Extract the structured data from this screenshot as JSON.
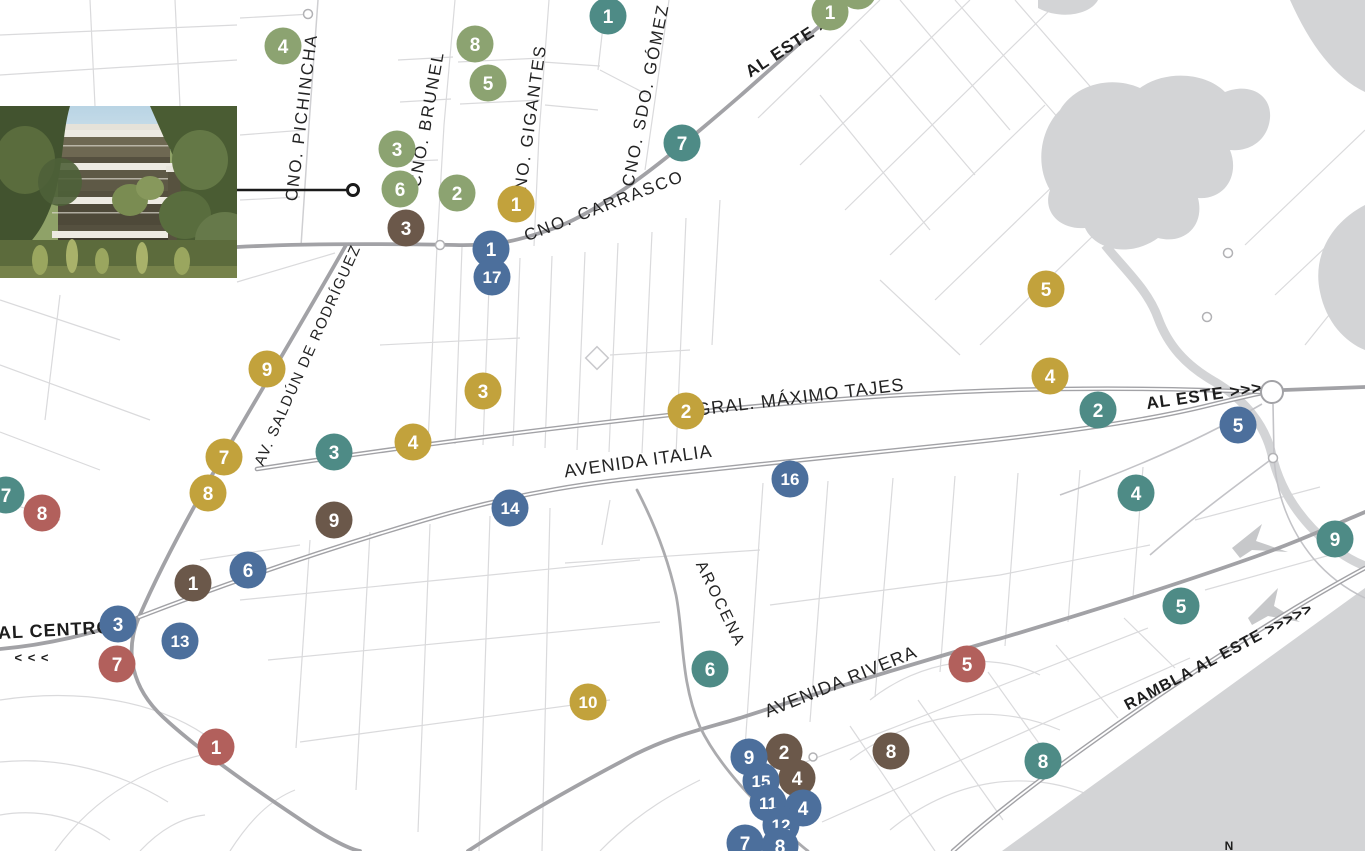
{
  "map": {
    "colors": {
      "background": "#ffffff",
      "water": "#d3d4d6",
      "road_main": "#a2a2a6",
      "road_secondary": "#c3c3c7",
      "road_minor": "#dadadc",
      "label_text": "#232323",
      "connector": "#1a1a1a"
    },
    "marker_colors": {
      "green": "#8ca371",
      "teal": "#4e8b86",
      "gold": "#c2a23c",
      "brown": "#6b584a",
      "blue": "#4c6f9c",
      "red": "#b2605c"
    },
    "street_labels": [
      {
        "text": "CNO. PICHINCHA",
        "x": 307,
        "y": 118,
        "rot": -83,
        "size": 17,
        "ls": 2
      },
      {
        "text": "CNO. BRUNEL",
        "x": 432,
        "y": 120,
        "rot": -80,
        "size": 17,
        "ls": 2
      },
      {
        "text": "CNO. GIGANTES",
        "x": 535,
        "y": 125,
        "rot": -82,
        "size": 17,
        "ls": 2
      },
      {
        "text": "CNO. SDO. GÓMEZ",
        "x": 651,
        "y": 96,
        "rot": -79,
        "size": 17,
        "ls": 2
      },
      {
        "text": "CNO. CARRASCO",
        "x": 606,
        "y": 211,
        "rot": -21,
        "size": 17,
        "ls": 2
      },
      {
        "text": "AV. SALDÚN DE RODRÍGUEZ",
        "x": 312,
        "y": 357,
        "rot": -66,
        "size": 15,
        "ls": 1.5
      },
      {
        "text": "GRAL. MÁXIMO TAJES",
        "x": 801,
        "y": 403,
        "rot": -7,
        "size": 18,
        "ls": 1
      },
      {
        "text": "AVENIDA ITALIA",
        "x": 639,
        "y": 467,
        "rot": -8,
        "size": 18,
        "ls": 1
      },
      {
        "text": "AROCENA",
        "x": 716,
        "y": 606,
        "rot": 64,
        "size": 16,
        "ls": 2
      },
      {
        "text": "AVENIDA RIVERA",
        "x": 843,
        "y": 687,
        "rot": -22,
        "size": 18,
        "ls": 1
      }
    ],
    "direction_labels": [
      {
        "text": "AL ESTE >",
        "x": 790,
        "y": 52,
        "rot": -33,
        "size": 17,
        "ls": 1
      },
      {
        "text": "AL ESTE >>>",
        "x": 1205,
        "y": 401,
        "rot": -8,
        "size": 17,
        "ls": 1
      },
      {
        "text": "AL CENTRO",
        "x": 55,
        "y": 636,
        "rot": -3,
        "size": 18,
        "ls": 1
      },
      {
        "text": "< < <",
        "x": 32,
        "y": 662,
        "rot": 0,
        "size": 13,
        "ls": 1
      },
      {
        "text": "RAMBLA AL ESTE >>>>>",
        "x": 1221,
        "y": 661,
        "rot": -28,
        "size": 16,
        "ls": 1
      },
      {
        "text": "N",
        "x": 1229,
        "y": 850,
        "rot": 0,
        "size": 12,
        "ls": 0
      }
    ],
    "markers": [
      {
        "num": "4",
        "color": "green",
        "x": 283,
        "y": 46
      },
      {
        "num": "8",
        "color": "green",
        "x": 475,
        "y": 44
      },
      {
        "num": "5",
        "color": "green",
        "x": 488,
        "y": 83
      },
      {
        "num": "1",
        "color": "teal",
        "x": 608,
        "y": 16
      },
      {
        "num": "1",
        "color": "green",
        "x": 830,
        "y": 12
      },
      {
        "num": "",
        "color": "green",
        "x": 858,
        "y": -9
      },
      {
        "num": "7",
        "color": "teal",
        "x": 682,
        "y": 143
      },
      {
        "num": "3",
        "color": "green",
        "x": 397,
        "y": 149
      },
      {
        "num": "6",
        "color": "green",
        "x": 400,
        "y": 189
      },
      {
        "num": "2",
        "color": "green",
        "x": 457,
        "y": 193
      },
      {
        "num": "1",
        "color": "gold",
        "x": 516,
        "y": 204
      },
      {
        "num": "3",
        "color": "brown",
        "x": 406,
        "y": 228
      },
      {
        "num": "1",
        "color": "blue",
        "x": 491,
        "y": 249
      },
      {
        "num": "17",
        "color": "blue",
        "x": 492,
        "y": 277
      },
      {
        "num": "9",
        "color": "gold",
        "x": 267,
        "y": 369
      },
      {
        "num": "3",
        "color": "gold",
        "x": 483,
        "y": 391
      },
      {
        "num": "2",
        "color": "gold",
        "x": 686,
        "y": 411
      },
      {
        "num": "5",
        "color": "gold",
        "x": 1046,
        "y": 289
      },
      {
        "num": "4",
        "color": "gold",
        "x": 1050,
        "y": 376
      },
      {
        "num": "2",
        "color": "teal",
        "x": 1098,
        "y": 410
      },
      {
        "num": "5",
        "color": "blue",
        "x": 1238,
        "y": 425
      },
      {
        "num": "7",
        "color": "gold",
        "x": 224,
        "y": 457
      },
      {
        "num": "8",
        "color": "gold",
        "x": 208,
        "y": 493
      },
      {
        "num": "3",
        "color": "teal",
        "x": 334,
        "y": 452
      },
      {
        "num": "4",
        "color": "gold",
        "x": 413,
        "y": 442
      },
      {
        "num": "4",
        "color": "teal",
        "x": 1136,
        "y": 493
      },
      {
        "num": "9",
        "color": "teal",
        "x": 1335,
        "y": 539
      },
      {
        "num": "16",
        "color": "blue",
        "x": 790,
        "y": 479
      },
      {
        "num": "14",
        "color": "blue",
        "x": 510,
        "y": 508
      },
      {
        "num": "9",
        "color": "brown",
        "x": 334,
        "y": 520
      },
      {
        "num": "7",
        "color": "teal",
        "x": 6,
        "y": 495
      },
      {
        "num": "8",
        "color": "red",
        "x": 42,
        "y": 513
      },
      {
        "num": "1",
        "color": "brown",
        "x": 193,
        "y": 583
      },
      {
        "num": "6",
        "color": "blue",
        "x": 248,
        "y": 570
      },
      {
        "num": "3",
        "color": "blue",
        "x": 118,
        "y": 624
      },
      {
        "num": "13",
        "color": "blue",
        "x": 180,
        "y": 641
      },
      {
        "num": "7",
        "color": "red",
        "x": 117,
        "y": 664
      },
      {
        "num": "1",
        "color": "red",
        "x": 216,
        "y": 747
      },
      {
        "num": "5",
        "color": "teal",
        "x": 1181,
        "y": 606
      },
      {
        "num": "6",
        "color": "teal",
        "x": 710,
        "y": 669
      },
      {
        "num": "10",
        "color": "gold",
        "x": 588,
        "y": 702
      },
      {
        "num": "5",
        "color": "red",
        "x": 967,
        "y": 664
      },
      {
        "num": "8",
        "color": "brown",
        "x": 891,
        "y": 751
      },
      {
        "num": "8",
        "color": "teal",
        "x": 1043,
        "y": 761
      },
      {
        "num": "2",
        "color": "brown",
        "x": 784,
        "y": 752
      },
      {
        "num": "9",
        "color": "blue",
        "x": 749,
        "y": 757
      },
      {
        "num": "4",
        "color": "brown",
        "x": 797,
        "y": 778
      },
      {
        "num": "15",
        "color": "blue",
        "x": 761,
        "y": 781
      },
      {
        "num": "11",
        "color": "blue",
        "x": 768,
        "y": 803
      },
      {
        "num": "4",
        "color": "blue",
        "x": 803,
        "y": 808
      },
      {
        "num": "12",
        "color": "blue",
        "x": 781,
        "y": 825
      },
      {
        "num": "7",
        "color": "blue",
        "x": 745,
        "y": 843
      },
      {
        "num": "8",
        "color": "blue",
        "x": 780,
        "y": 846
      }
    ],
    "photo": {
      "description": "Rendering of a modern terraced apartment building surrounded by trees and native gardens",
      "connector": {
        "x1": 237,
        "y1": 190,
        "x2": 347,
        "y2": 190,
        "ring_x": 353,
        "ring_y": 190
      }
    }
  }
}
